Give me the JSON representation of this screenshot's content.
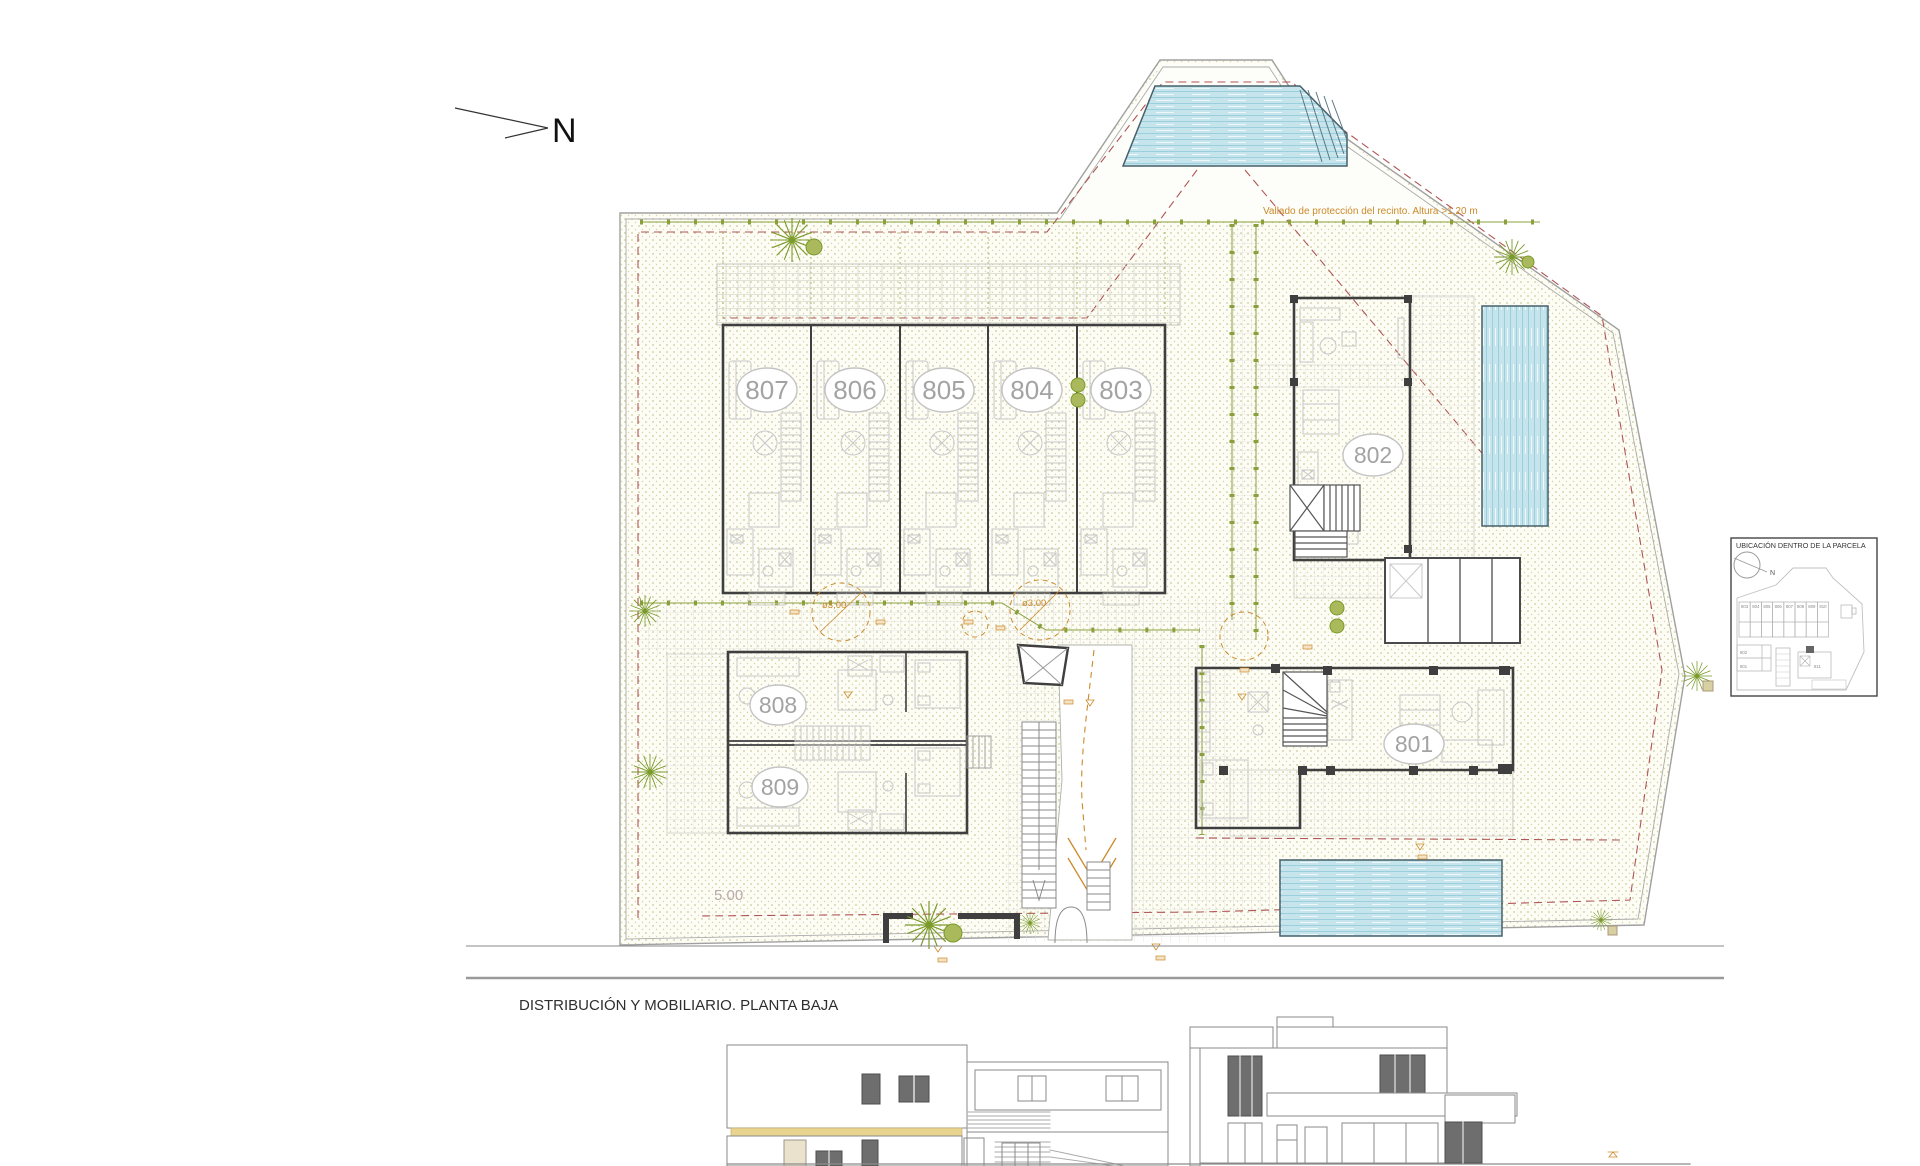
{
  "drawing": {
    "north_label": "N",
    "plan_title": "DISTRIBUCIÓN Y MOBILIARIO. PLANTA BAJA",
    "fence_note": "Vallado de protección del recinto. Altura >1,20 m",
    "setback_dim": "5.00",
    "turning_circle_left": "ø3,00",
    "turning_circle_right": "ø3.00",
    "units": {
      "u801": "801",
      "u802": "802",
      "u803": "803",
      "u804": "804",
      "u805": "805",
      "u806": "806",
      "u807": "807",
      "u808": "808",
      "u809": "809"
    },
    "inset": {
      "title": "UBICACIÓN DENTRO DE LA PARCELA",
      "north_label": "N",
      "row_units": [
        "803",
        "804",
        "805",
        "806",
        "807",
        "808",
        "809",
        "810"
      ],
      "stack_units": [
        "802",
        "801"
      ],
      "detached_unit": "811"
    },
    "colors": {
      "wall": "#3f3f3f",
      "furniture": "#c8c8c8",
      "unit_label": "#a3a3a3",
      "garden_dot": "#c9c99a",
      "fence_green": "#8aa03c",
      "boundary_red": "#b05555",
      "annotation_orange": "#cc8a2a",
      "water": "#c6e4ec",
      "elevation_band_yellow": "#e8d48e"
    }
  }
}
